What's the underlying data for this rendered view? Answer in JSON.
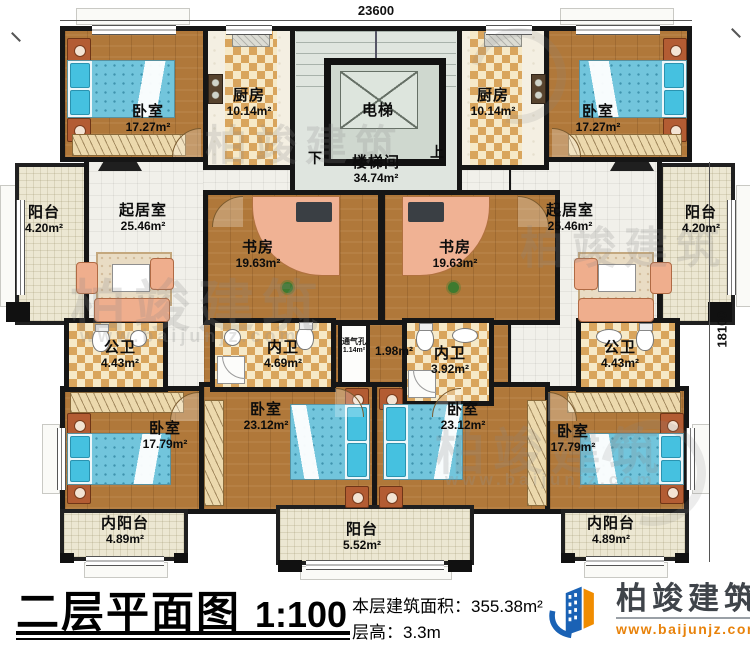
{
  "plan": {
    "dims": {
      "width": "23600",
      "height": "18100"
    },
    "stair": {
      "elevator": "电梯",
      "name": "楼梯间",
      "area": "34.74m²",
      "up": "上",
      "down": "下"
    },
    "rooms": {
      "bedroom_tl": {
        "name": "卧室",
        "area": "17.27m²"
      },
      "kitchen_tl": {
        "name": "厨房",
        "area": "10.14m²"
      },
      "kitchen_tr": {
        "name": "厨房",
        "area": "10.14m²"
      },
      "bedroom_tr": {
        "name": "卧室",
        "area": "17.27m²"
      },
      "balcony_left": {
        "name": "阳台",
        "area": "4.20m²"
      },
      "living_left": {
        "name": "起居室",
        "area": "25.46m²"
      },
      "study_left": {
        "name": "书房",
        "area": "19.63m²"
      },
      "study_right": {
        "name": "书房",
        "area": "19.63m²"
      },
      "living_right": {
        "name": "起居室",
        "area": "25.46m²"
      },
      "balcony_right": {
        "name": "阳台",
        "area": "4.20m²"
      },
      "bath_public_left": {
        "name": "公卫",
        "area": "4.43m²"
      },
      "bath_inner_left": {
        "name": "内卫",
        "area": "4.69m²"
      },
      "vent": {
        "name": "通气孔",
        "area": "1.14m²"
      },
      "hall_center": {
        "area": "1.98m²"
      },
      "bath_inner_right": {
        "name": "内卫",
        "area": "3.92m²"
      },
      "bath_public_right": {
        "name": "公卫",
        "area": "4.43m²"
      },
      "bedroom_bl": {
        "name": "卧室",
        "area": "17.79m²"
      },
      "bedroom_bcl": {
        "name": "卧室",
        "area": "23.12m²"
      },
      "bedroom_bcr": {
        "name": "卧室",
        "area": "23.12m²"
      },
      "bedroom_br": {
        "name": "卧室",
        "area": "17.79m²"
      },
      "inner_balcony_bl": {
        "name": "内阳台",
        "area": "4.89m²"
      },
      "balcony_bottom": {
        "name": "阳台",
        "area": "5.52m²"
      },
      "inner_balcony_br": {
        "name": "内阳台",
        "area": "4.89m²"
      }
    }
  },
  "title_block": {
    "title": "二层平面图",
    "scale": "1:100",
    "area_label": "本层建筑面积：",
    "area_value": "355.38m²",
    "height_label": "层高：",
    "height_value": "3.3m"
  },
  "logo": {
    "name": "柏竣建筑",
    "website": "www.baijunjz.com"
  },
  "watermark": {
    "text": "柏竣建筑",
    "url": "www.baijunjz.com"
  },
  "colors": {
    "wall": "#161616",
    "wood_floor": "#b0783a",
    "checker": "#d9a55d",
    "bed_blue": "#72c5dc",
    "logo_blue": "#1a62b5",
    "logo_orange": "#f08c00"
  }
}
